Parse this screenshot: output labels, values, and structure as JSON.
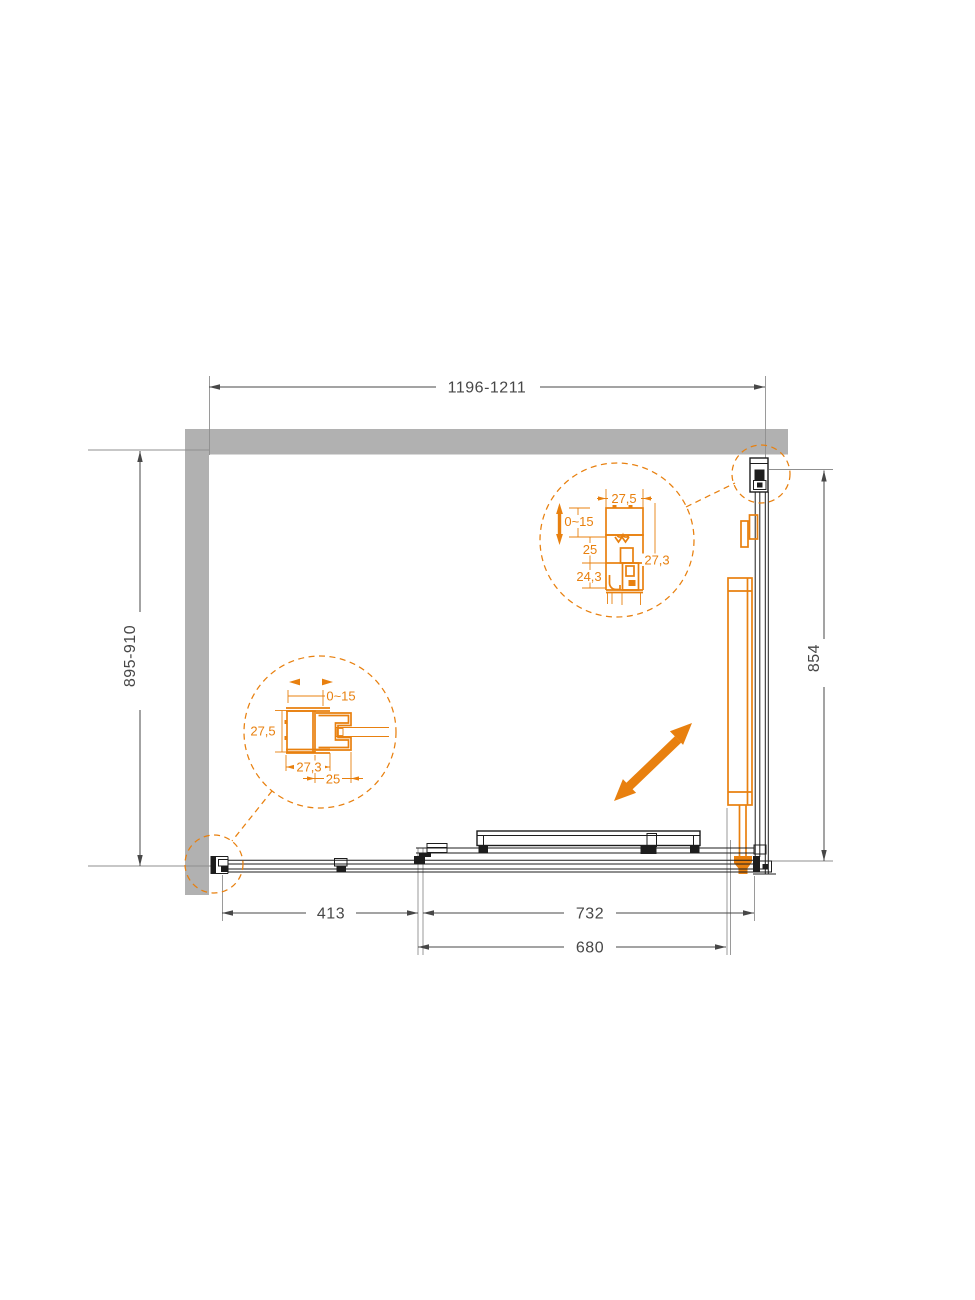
{
  "page": {
    "background": "#ffffff"
  },
  "drawing": {
    "type": "shower-enclosure-plan-technical-drawing",
    "dimensions": {
      "top_width": "1196-1211",
      "left_depth": "895-910",
      "right_height": "854",
      "bottom_fixed": "413",
      "bottom_opening": "732",
      "bottom_door": "680"
    },
    "detail_left": {
      "adjust": "0~15",
      "width": "27,5",
      "profile_width": "27,3",
      "depth": "25"
    },
    "detail_right": {
      "width": "27,5",
      "adjust": "0~15",
      "depth": "25",
      "lower_depth": "24,3",
      "side": "27,3"
    },
    "colors": {
      "accent": "#e8800f",
      "wall": "#b1b1b1",
      "line": "#1d1d1d",
      "dim": "#474747",
      "ext": "#8f8f8f"
    }
  }
}
